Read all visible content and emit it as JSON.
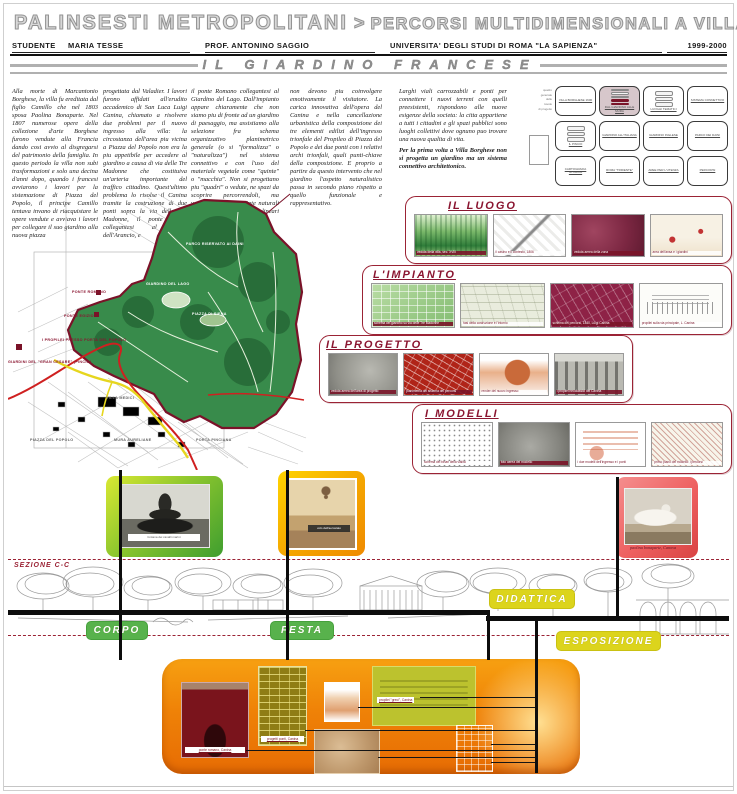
{
  "header": {
    "title_left": "PALINSESTI METROPOLITANI",
    "title_sep": ">",
    "title_right": "PERCORSI MULTIDIMENSIONALI A VILLA BORGHESE",
    "student_label": "STUDENTE",
    "student_name": "MARIA TESSE",
    "professor": "PROF. ANTONINO SAGGIO",
    "university": "UNIVERSITA' DEGLI STUDI DI ROMA \"LA SAPIENZA\"",
    "year": "1999-2000",
    "subtitle": "IL GIARDINO FRANCESE"
  },
  "intro": {
    "col1": "Alla morte di Marcantonio Borghese, la villa fu ereditata dal figlio Camillo che nel 1803 sposa Paolina Bonaparte. Nel 1807 numerose opere della collezione d'arte Borghese furono vendute alla Francia dando cosi avvio al disgregarsi del patrimonio della famiglia. In questo periodo la villa non subi trasformazioni e solo una decina d'anni dopo, quando i francesi avviarono i lavori per la sistemazione di Piazza del Popolo, il principe Camillo tentava invano di riacquistare le opere vendute e avviava i lavori per collegare il suo giardino alla nuova piazza",
    "col2": "progettata dal Valadier. I lavori furono affidati all'erudito accademico di San Luca Luigi Canina, chiamato a risolvere due problemi per il nuovo ingresso alla villa: la circostanza dell'area piu vicina a Piazza del Popolo non era la piu appetibile per accedere al giardino a causa di via delle Tre Madonne che costituiva un'arteria importante del traffico cittadino. Quest'ultimo problema lo risolse il Canina tramite la costruzione di due ponti sopra la via delle Tre Madonne, il ponte Egizio collegantesi al viale dell'Arancio, e",
    "col3": "il ponte Romano collegantesi al Giardino del Lago. Dall'impianto appare chiaramente che non siamo piu di fronte ad un giardino di paesaggio, ma assistiamo alla selezione fra schema organizzativo planimetrico generale (o si \"formalizza\" o \"naturalizza\") nel sistema connettivo e con l'uso del materiale vegetale come \"quinte\" o \"macchia\". Non si progettano piu \"quadri\" o vedute, ne spazi da scoprire percorrendoli, ma vengono proposte quinte naturali ai lati dei percorsi veloci, lineari e simmetrici che",
    "col4": "non devono piu coinvolgere emotivamente il visitatore. La carica innovativa dell'opera del Canina e nella cancellazione urbanistica della composizione dei tre elementi edilizi dell'ingresso trionfale del Propileo di Piazza del Popolo e dei due ponti con i relativi archi trionfali, quali punti-chiave della composizione. E proprio a partire da questo intervento che nel giardino l'aspetto naturalistico passa in secondo piano rispetto a quello funzionale e rappresentativo.",
    "col5a": "Larghi viali carrozzabili e ponti per connettere i nuovi terreni con quelli preesistenti, rispondono alle nuove esigenze della societa: la citta appartiene a tutti i cittadini e gli spazi pubblici sono luoghi collettivi dove ognuno puo trovare una nuova qualita di vita.",
    "col5b": "Per la prima volta a Villa Borghese non si progetta un giardino ma un sistema connettivo architettonico."
  },
  "nav_grid": {
    "cards": [
      {
        "label": "VILLA BORGHESE 1600",
        "bars": false,
        "active": false
      },
      {
        "label": "DAL GIARDINO ALLE MURA",
        "bars": true,
        "active": true
      },
      {
        "label": "LUOGHI TEMATICI",
        "bars": true,
        "active": false
      },
      {
        "label": "SISTEMA CONNETTIVO",
        "bars": false,
        "active": false
      },
      {
        "label": "IL PINCIO",
        "bars": true,
        "active": false
      },
      {
        "label": "GIARDINO ALL'ITALIANA",
        "bars": false,
        "active": false
      },
      {
        "label": "GIARDINO INGLESE",
        "bars": false,
        "active": false
      },
      {
        "label": "PARCO DEI DAINI",
        "bars": false,
        "active": false
      },
      {
        "label": "CARTOGRAFIA STORICA",
        "bars": false,
        "active": false
      },
      {
        "label": "ROMA \"TRIDENTE\"",
        "bars": false,
        "active": false
      },
      {
        "label": "AREE PER L'UTENZA",
        "bars": false,
        "active": false
      },
      {
        "label": "PERCORSI",
        "bars": false,
        "active": false
      }
    ],
    "side_caption": [
      "quadro",
      "generale",
      "delle",
      "tavole",
      "di progetto"
    ]
  },
  "map": {
    "labels": [
      "PONTE ROMANO",
      "PONTE EGIZIO",
      "GIARDINO DEL LAGO",
      "I PROPILEI PRESSO PORTA DEL POPOLO",
      "GIARDINI DEL \"GRAN CESARE\" (PINCIO)",
      "PIAZZA DI SIENA",
      "PARCO RISERVATO AI DAINI",
      "VILLA MEDICI",
      "PIAZZA DEL POPOLO",
      "MURA AURELIANE",
      "PORTA PINCIANA"
    ]
  },
  "strips": [
    {
      "title": "IL LUOGO",
      "images": [
        {
          "caption": "veduta della villa, sec. XVIII",
          "style": "green-engraving",
          "cap": "dark"
        },
        {
          "caption": "il casino e il contesto, 1806",
          "style": "bw-map",
          "cap": "light"
        },
        {
          "caption": "veduta aerea della zona",
          "style": "maroon-photo",
          "cap": "dark"
        },
        {
          "caption": "area dell'ansa e i giardini",
          "style": "sepia-drawing",
          "cap": "light"
        }
      ]
    },
    {
      "title": "L'IMPIANTO",
      "images": [
        {
          "caption": "schema del giardino su via delle Tre Madonne",
          "style": "green-map",
          "cap": "dark"
        },
        {
          "caption": "fasi della costruzione e l'intorno",
          "style": "pale-plan",
          "cap": "light"
        },
        {
          "caption": "schema dei percorsi, 1840, Luigi Canina",
          "style": "maroon-map",
          "cap": "dark"
        },
        {
          "caption": "propilei sulla via principale, L. Canina",
          "style": "white-elevation",
          "cap": "light"
        }
      ]
    },
    {
      "title": "IL PROGETTO",
      "images": [
        {
          "caption": "veduta aerea dell'area di progetto",
          "style": "grey-aerial",
          "cap": "dark"
        },
        {
          "caption": "planimetria del sistema dei percorsi",
          "style": "red-map",
          "cap": "dark"
        },
        {
          "caption": "render del nuovo ingresso",
          "style": "red-render",
          "cap": "light"
        },
        {
          "caption": "i propilei neoclassici del Canina",
          "style": "grey-engraving",
          "cap": "dark"
        }
      ]
    },
    {
      "title": "I MODELLI",
      "images": [
        {
          "caption": "schema dei binari della vialita",
          "style": "line-plan",
          "cap": "light"
        },
        {
          "caption": "foto aerea del modello",
          "style": "grey-aerial2",
          "cap": "dark"
        },
        {
          "caption": "i due modelli dell'ingresso e i ponti",
          "style": "orange-elevation",
          "cap": "light"
        },
        {
          "caption": "primo piano del modello: i percorsi",
          "style": "hatch-plan",
          "cap": "light"
        }
      ]
    }
  ],
  "photos": [
    {
      "caption": "fontana dei cavalli marini"
    },
    {
      "caption": "volo dell'aerostato"
    },
    {
      "caption": "paolina bonaparte, Canova"
    }
  ],
  "section": {
    "label": "SEZIONE C-C",
    "pill_corpo": "CORPO",
    "pill_festa": "FESTA",
    "pill_didattica": "DIDATTICA",
    "pill_esposizione": "ESPOSIZIONE"
  },
  "bottom_panel": {
    "captions": {
      "arch": "ponte romano, Canina",
      "plans": "progetti ponti, Canina",
      "elevations": "propilei \"greci\", Canina"
    }
  },
  "colors": {
    "accent_red": "#8a1530",
    "accent_green": "#58b24c",
    "accent_yellow": "#dcd41c",
    "accent_orange": "#ee7d06",
    "park_green": "#388b4b"
  }
}
